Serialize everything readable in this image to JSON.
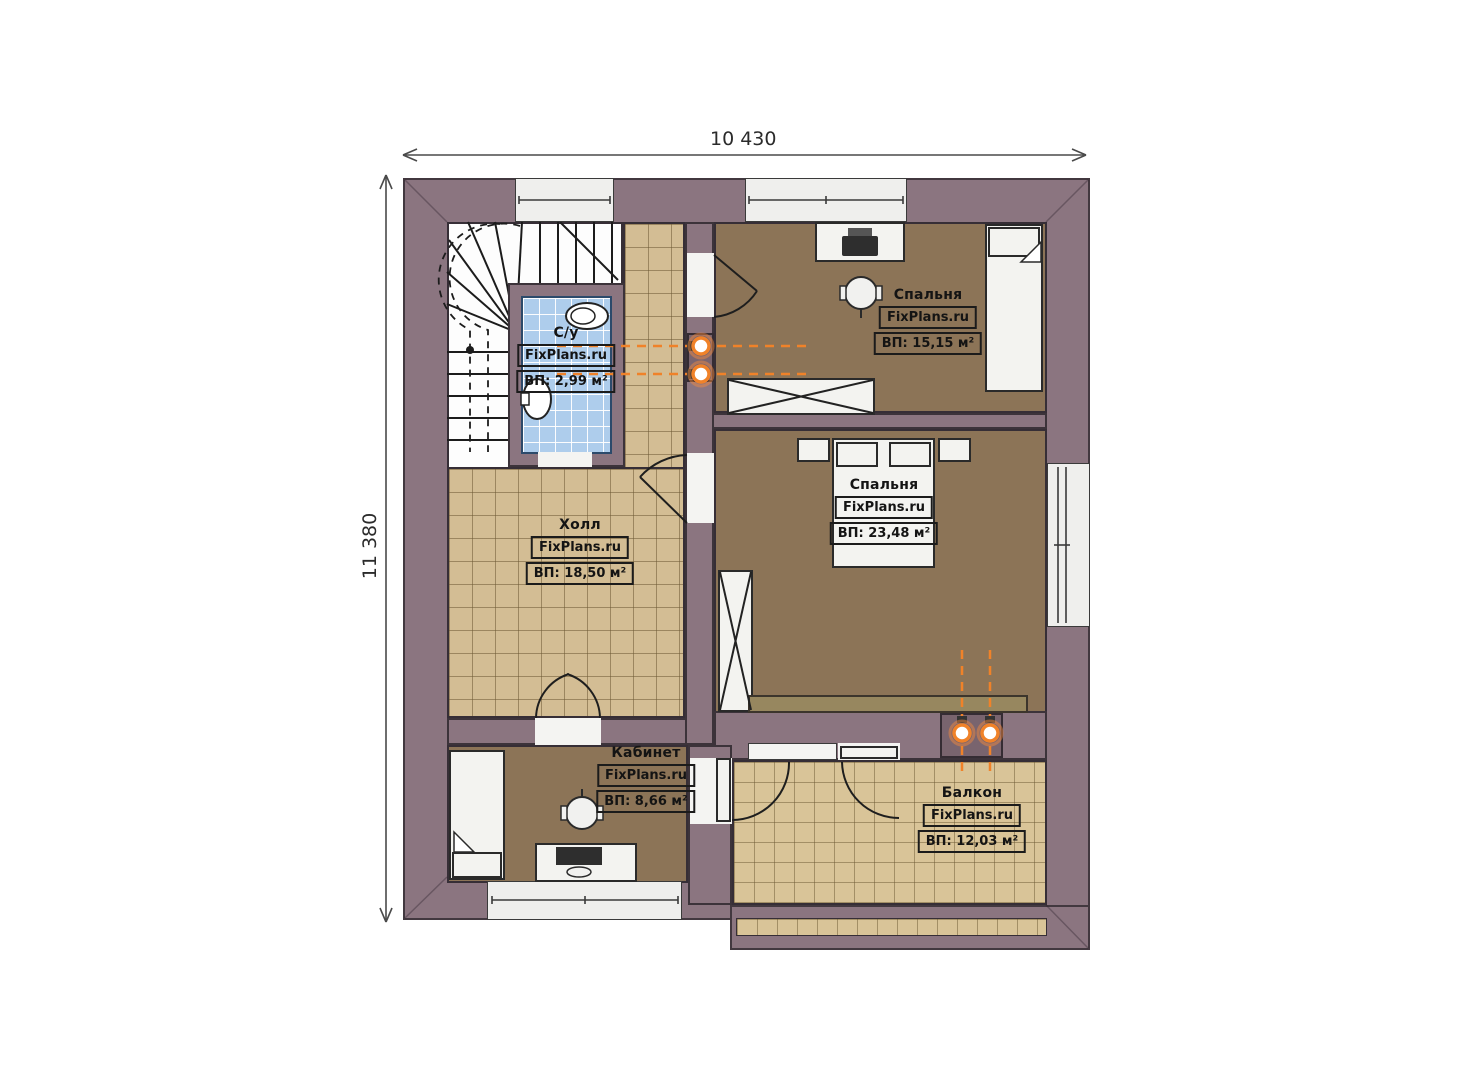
{
  "plan": {
    "type": "floor-plan",
    "watermark": "FixPlans.ru",
    "dimensions": {
      "width_mm": "10 430",
      "height_mm": "11 380"
    },
    "rooms": [
      {
        "key": "wc",
        "name": "С/у",
        "brand": "FixPlans.ru",
        "area_label": "ВП: 2,99 м²"
      },
      {
        "key": "bedroom_small",
        "name": "Спальня",
        "brand": "FixPlans.ru",
        "area_label": "ВП: 15,15 м²"
      },
      {
        "key": "bedroom_large",
        "name": "Спальня",
        "brand": "FixPlans.ru",
        "area_label": "ВП: 23,48 м²"
      },
      {
        "key": "hall",
        "name": "Холл",
        "brand": "FixPlans.ru",
        "area_label": "ВП: 18,50 м²"
      },
      {
        "key": "office",
        "name": "Кабинет",
        "brand": "FixPlans.ru",
        "area_label": "ВП: 8,66 м²"
      },
      {
        "key": "balcony",
        "name": "Балкон",
        "brand": "FixPlans.ru",
        "area_label": "ВП: 12,03 м²"
      }
    ],
    "colors": {
      "wall": "#8b7580",
      "floor_wood": "#8c7457",
      "tile_hall": "#d3bd94",
      "tile_balcony": "#d9c498",
      "tile_wc": "#aecdec",
      "fixture_white": "#f3f3f0",
      "accent_orange": "#f08229"
    }
  }
}
